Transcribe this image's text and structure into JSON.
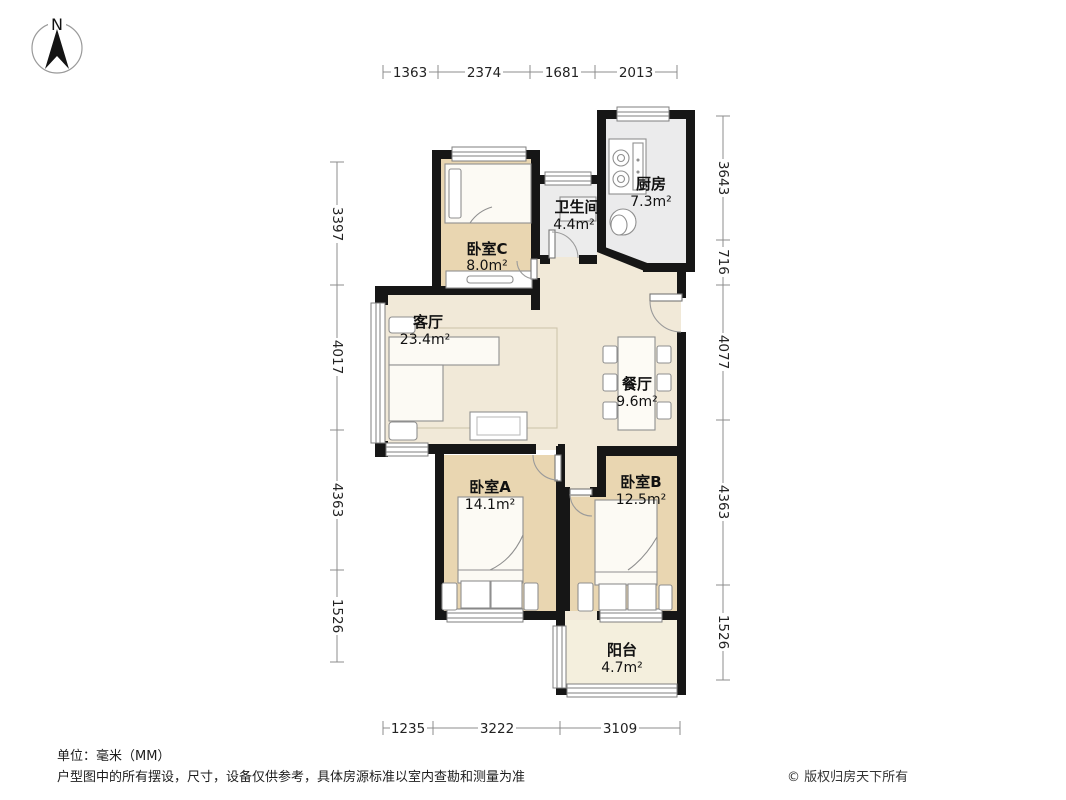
{
  "compass": {
    "label": "N"
  },
  "rooms": [
    {
      "id": "bedroom-c",
      "name": "卧室C",
      "area": "8.0m²"
    },
    {
      "id": "bathroom",
      "name": "卫生间",
      "area": "4.4m²"
    },
    {
      "id": "kitchen",
      "name": "厨房",
      "area": "7.3m²"
    },
    {
      "id": "living",
      "name": "客厅",
      "area": "23.4m²"
    },
    {
      "id": "dining",
      "name": "餐厅",
      "area": "9.6m²"
    },
    {
      "id": "bedroom-a",
      "name": "卧室A",
      "area": "14.1m²"
    },
    {
      "id": "bedroom-b",
      "name": "卧室B",
      "area": "12.5m²"
    },
    {
      "id": "balcony",
      "name": "阳台",
      "area": "4.7m²"
    }
  ],
  "dimensions": {
    "unit": "mm",
    "top": [
      "1363",
      "2374",
      "1681",
      "2013"
    ],
    "bottom": [
      "1235",
      "3222",
      "3109"
    ],
    "left": [
      "3397",
      "4017",
      "4363",
      "1526"
    ],
    "right": [
      "3643",
      "716",
      "4077",
      "4363",
      "1526"
    ]
  },
  "footer": {
    "unit_note": "单位：毫米（MM）",
    "disclaimer": "户型图中的所有摆设，尺寸，设备仅供参考，具体房源标准以室内查勘和测量为准",
    "copyright": "© 版权归房天下所有"
  },
  "colors": {
    "wall": "#161616",
    "bedroom_floor": "#e9d6b1",
    "living_floor": "#f1e9d8",
    "kitchen_floor": "#ebebec",
    "balcony_floor": "#f4efdd",
    "dim_line": "#8c8c8c"
  }
}
